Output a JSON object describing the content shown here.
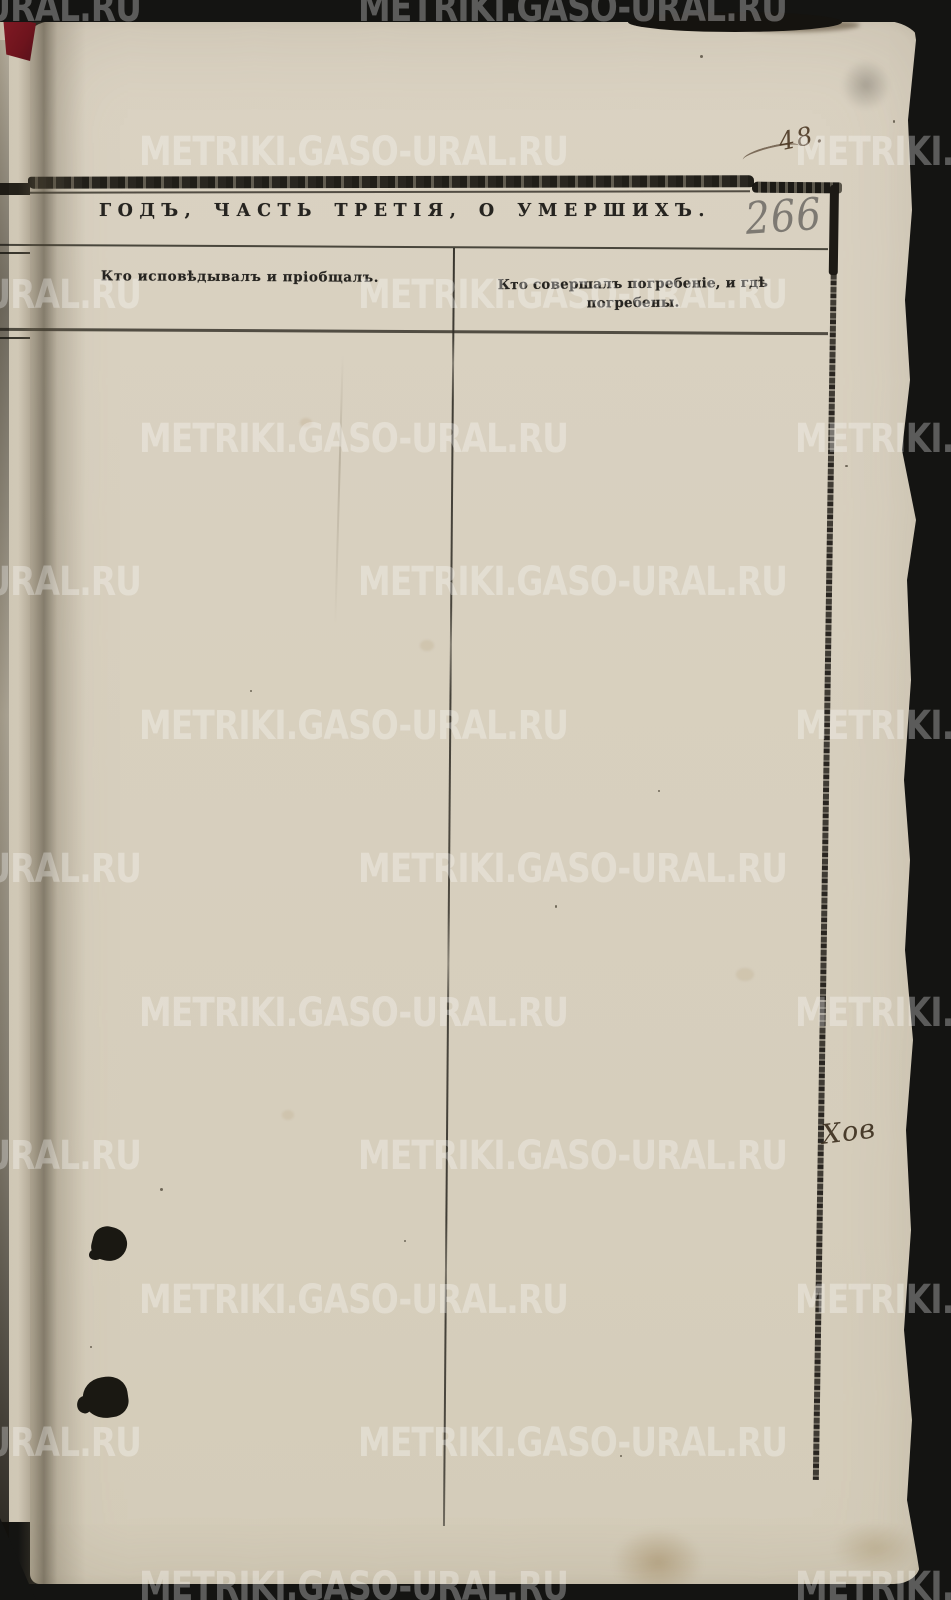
{
  "document": {
    "kind": "metric-book-page-scan",
    "title": "ГОДЪ, ЧАСТЬ ТРЕТІЯ, О УМЕРШИХЪ.",
    "columns": [
      {
        "header": "Кто исповѣдывалъ и пріобщалъ."
      },
      {
        "header": "Кто совершалъ погребеніе, и гдѣ погребены."
      }
    ],
    "handwritten": {
      "page_number_pencil": "266",
      "corner_note_ink": "48.",
      "margin_note_ink": "Хов"
    }
  },
  "watermark": {
    "text": "METRIKI.GASO-URAL.RU",
    "opacity": 0.3
  },
  "colors": {
    "background": "#141412",
    "paper": "#d8d0bf",
    "cover_red": "#6e141d",
    "print": "#262420",
    "rule": "#39362d",
    "pencil": "#6c6a64",
    "brown_ink": "#4a3622",
    "watermark": "#ffffff"
  }
}
